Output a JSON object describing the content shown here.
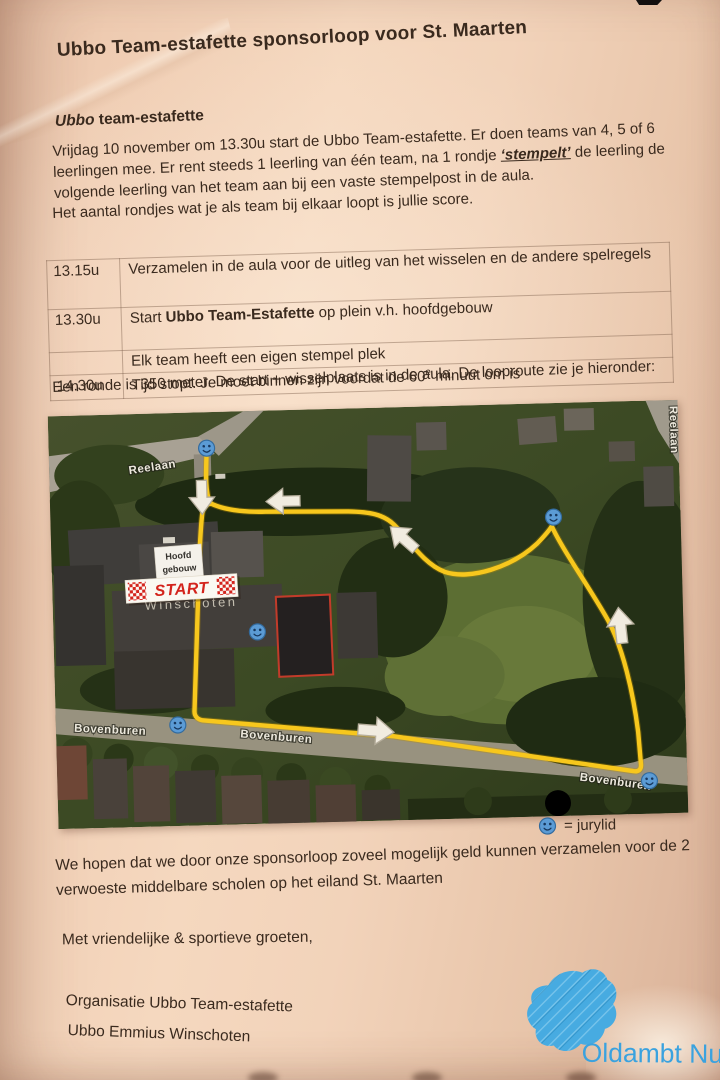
{
  "document": {
    "title": "Ubbo Team-estafette sponsorloop voor St. Maarten",
    "heading_italic": "Ubbo",
    "heading_rest": " team-estafette",
    "intro_a": "Vrijdag 10 november om 13.30u start de Ubbo Team-estafette. Er doen teams van 4, 5 of 6 leerlingen mee. Er rent steeds 1 leerling van één team, na 1 rondje ",
    "intro_stempelt": "‘stempelt’",
    "intro_b": " de leerling de volgende leerling van het team aan bij een vaste stempelpost in de aula.",
    "score_line": "Het aantal rondjes wat je als team bij elkaar loopt is jullie score.",
    "route_line": "Een ronde is 350 meter. De start + wisselplaats is in de aula. De looproute zie je hieronder:"
  },
  "schedule": {
    "rows": [
      {
        "time": "13.15u",
        "text": "Verzamelen in de aula voor de uitleg van het wisselen en de andere spelregels"
      },
      {
        "time": "13.30u",
        "prefix": "Start ",
        "bold": "Ubbo Team-Estafette",
        "suffix": " op plein v.h. hoofdgebouw"
      },
      {
        "time": "",
        "text": "Elk team heeft een eigen stempel plek"
      },
      {
        "time": "14.30u",
        "prefix": "Tijd stopt. Je moet binnen zijn voordat de 60",
        "sup": "e",
        "suffix": " minuut om is"
      }
    ]
  },
  "map": {
    "street_reelaan": "Reelaan",
    "street_reelaan_vertical": "Reelaan",
    "street_bovenburen": "Bovenburen",
    "hoofdgebouw_line1": "Hoofd",
    "hoofdgebouw_line2": "gebouw",
    "start_label": "START",
    "city_label": "Winschoten"
  },
  "legend": {
    "text": "= jurylid"
  },
  "closing": {
    "paragraph": "We hopen dat we door onze sponsorloop zoveel mogelijk geld kunnen verzamelen voor de 2 verwoeste middelbare scholen op het eiland St. Maarten",
    "greeting": "Met vriendelijke & sportieve groeten,",
    "org_line1": "Organisatie Ubbo Team-estafette",
    "org_line2": "Ubbo Emmius Winschoten"
  },
  "logo": {
    "text": "Oldambt Nu"
  },
  "colors": {
    "paper": "#f2d3ba",
    "ink": "#3a2a1e",
    "route_yellow": "#f7c71d",
    "jury_marker_blue": "#5b9bd5",
    "start_red": "#d3231c",
    "logo_blue": "#3aa2df"
  }
}
